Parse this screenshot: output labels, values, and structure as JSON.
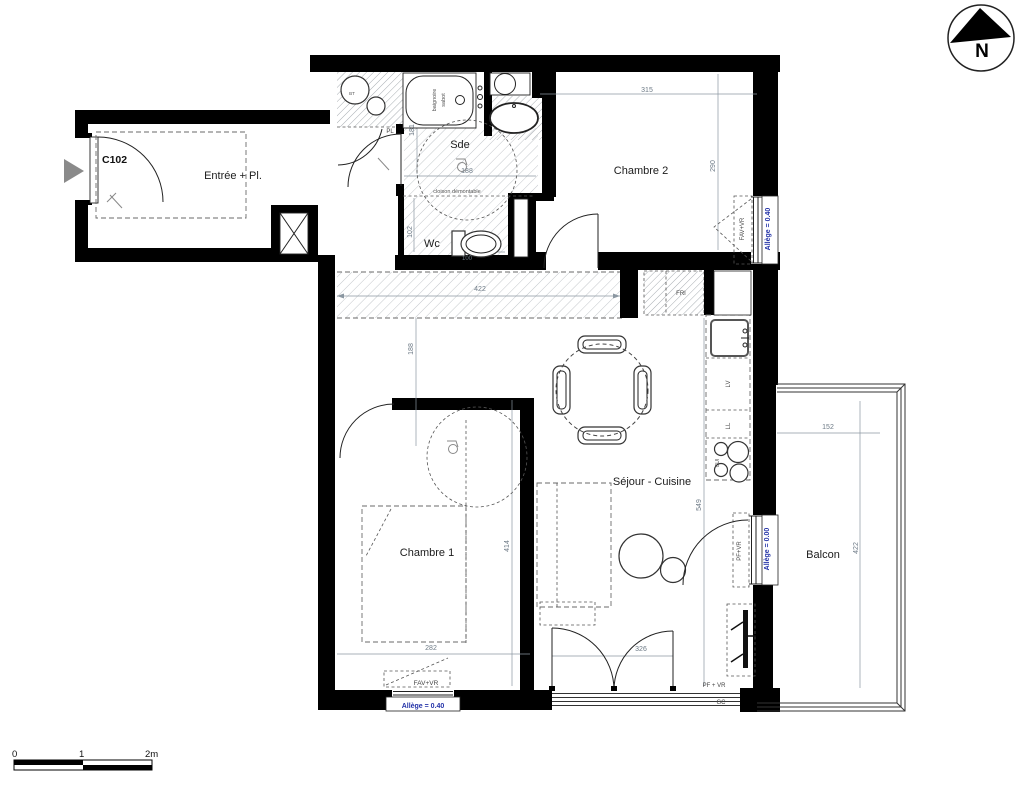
{
  "title": {
    "unit": "C102",
    "north": "N"
  },
  "rooms": {
    "entree": "Entrée + Pl.",
    "sde": "Sde",
    "wc": "Wc",
    "chambre2": "Chambre 2",
    "chambre1": "Chambre 1",
    "sejour": "Séjour - Cuisine",
    "balcon": "Balcon"
  },
  "equipment": {
    "bt": "BT",
    "pl": "PL",
    "baignoire_line1": "baignoire",
    "baignoire_line2": "sabot",
    "cloison": "cloison démontable",
    "fri": "FRI",
    "lv": "LV",
    "ll": "LL",
    "cui": "CUI"
  },
  "dims": {
    "ch2_width": "315",
    "ch2_height": "290",
    "sde_width": "188",
    "sde_depth": "181",
    "wc_depth": "102",
    "wc_width": "100",
    "hall_width": "422",
    "hall_depth": "188",
    "ch1_depth": "414",
    "ch1_width": "282",
    "kitchen_run": "549",
    "bay_width": "326",
    "balcon_width": "152",
    "balcon_depth": "422"
  },
  "openings": {
    "fav_vr_ch2": "FAV+VR",
    "allege_ch2": "Allège = 0.40",
    "pf_vr_balcon": "PF+VR",
    "allege_balcon": "Allège = 0.00",
    "fav_vr_ch1": "FAV+VR",
    "allege_ch1": "Allège = 0.40",
    "pf_vr_bay": "PF + VR",
    "gc": "GC"
  },
  "scale_bar": {
    "zero": "0",
    "one": "1",
    "two": "2m"
  },
  "colors": {
    "wall": "#000000",
    "dim_text": "#6d7a86",
    "allege_text": "#2433a8",
    "hatch_line": "#b8bcc0",
    "room_text": "#1c1c1c"
  }
}
